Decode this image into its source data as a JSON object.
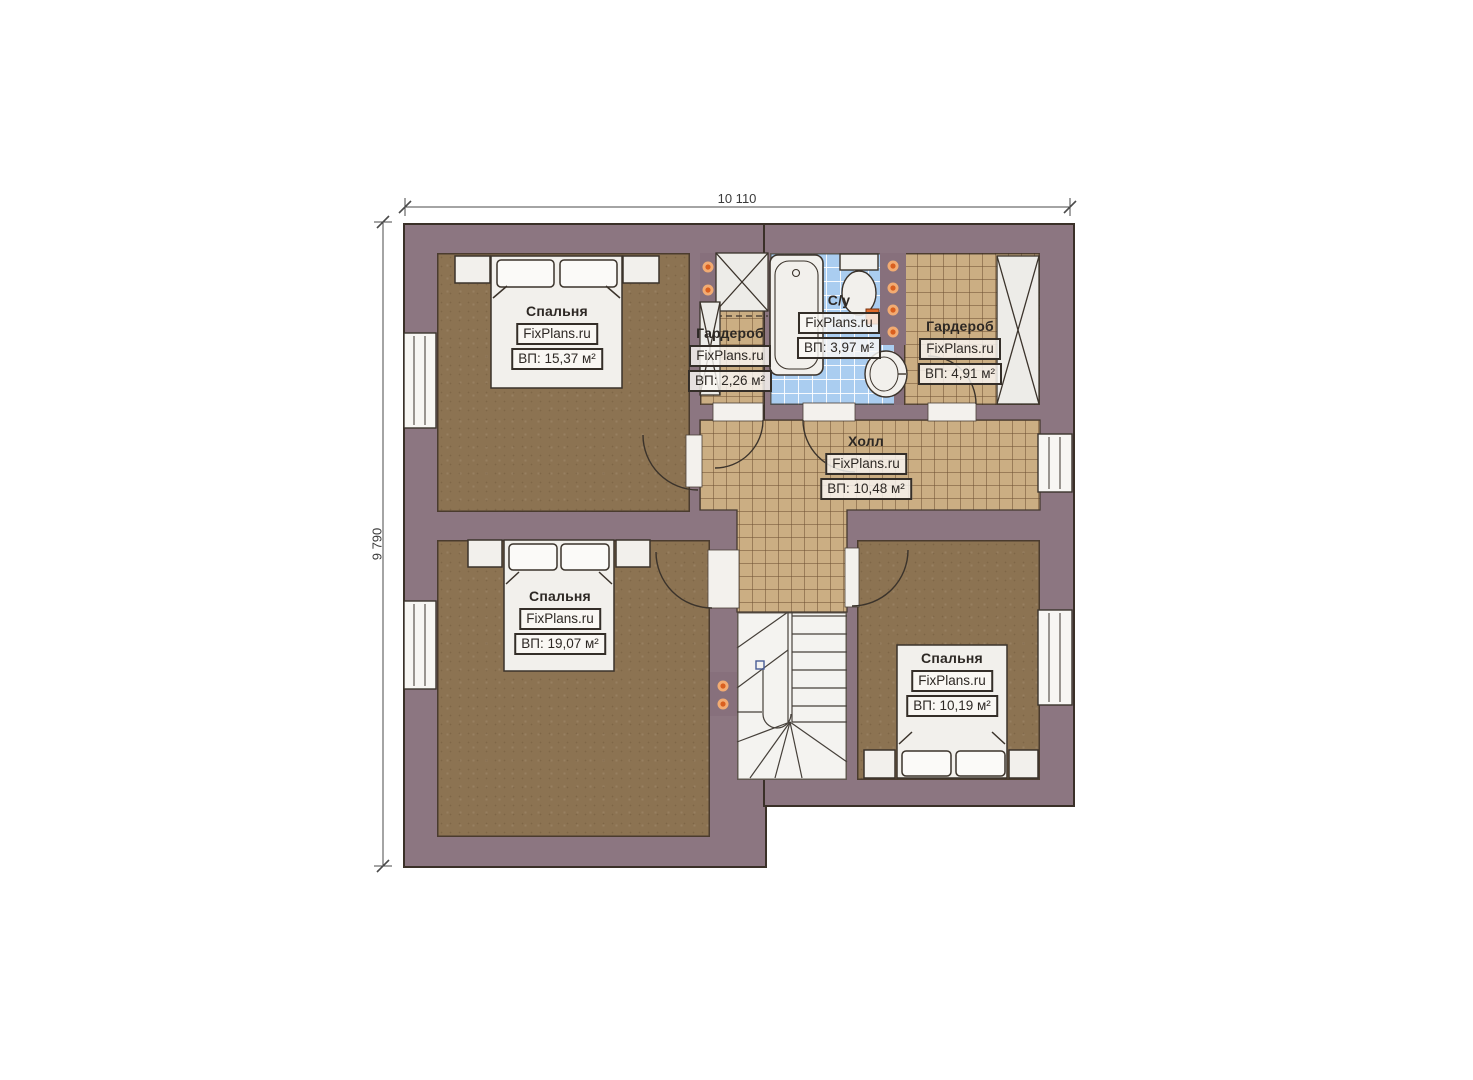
{
  "plan": {
    "type": "floor-plan",
    "dimensions": {
      "width_label": "10 110",
      "height_label": "9 790"
    },
    "watermark": "FixPlans.ru",
    "rooms": [
      {
        "id": "bedroom-top-left",
        "name": "Спальня",
        "area_label": "ВП: 15,37 м²"
      },
      {
        "id": "wardrobe-left",
        "name": "Гардероб",
        "area_label": "ВП: 2,26 м²"
      },
      {
        "id": "bathroom",
        "name": "С/у",
        "area_label": "ВП: 3,97 м²"
      },
      {
        "id": "wardrobe-right",
        "name": "Гардероб",
        "area_label": "ВП: 4,91 м²"
      },
      {
        "id": "hall",
        "name": "Холл",
        "area_label": "ВП: 10,48 м²"
      },
      {
        "id": "bedroom-bottom-left",
        "name": "Спальня",
        "area_label": "ВП: 19,07 м²"
      },
      {
        "id": "bedroom-bottom-right",
        "name": "Спальня",
        "area_label": "ВП: 10,19 м²"
      }
    ],
    "fixtures": [
      "bed-icon",
      "nightstand-icon",
      "wardrobe-cabinet-icon",
      "bathtub-icon",
      "toilet-icon",
      "sink-icon",
      "stairs-icon",
      "door-arc-icon",
      "window-icon",
      "wall-lamp-dot-icon",
      "radiator-icon"
    ],
    "colors": {
      "wall": "#8c7681",
      "outline": "#3b332b",
      "wood_floor": "#8c7352",
      "tile_floor": "#cbae83",
      "bathroom_tile": "#aacdf0",
      "stairs": "#f4f3f0",
      "furniture": "#f2f0ec",
      "accent_dot": "#d95f1f",
      "radiator": "#e06a2a"
    }
  }
}
